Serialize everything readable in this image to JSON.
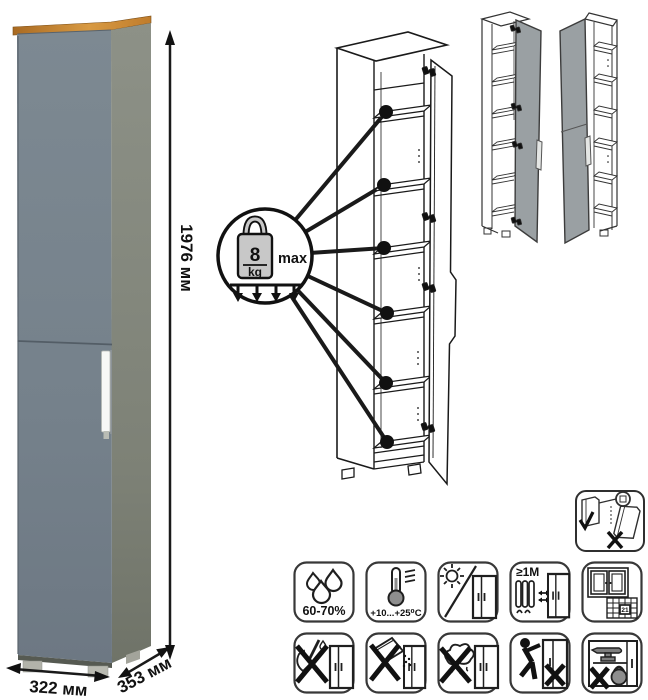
{
  "title": "tall-cabinet-dimensions-and-care-diagram",
  "product": {
    "dimensions": {
      "height_label": "1976 мм",
      "width_label": "322 мм",
      "depth_label": "353 мм"
    },
    "colors": {
      "door": "#76828c",
      "side": "#878b80",
      "wood_top": "#c9882f",
      "handle": "#f6f7f5",
      "variant_door": "#9aa0a3"
    }
  },
  "shelf_callout": {
    "weight_value": "8",
    "weight_unit": "kg",
    "max_label": "max",
    "shelf_count": 6
  },
  "care_instructions": {
    "humidity": {
      "name": "humidity-range",
      "label": "60-70%"
    },
    "temperature": {
      "name": "temperature-range",
      "label": "+10...+25⁰C"
    },
    "sunlight": {
      "name": "avoid-direct-sunlight",
      "label": ""
    },
    "heat_distance": {
      "name": "keep-distance-from-heaters",
      "label": "≥1М"
    },
    "ventilation": {
      "name": "ventilate-room-calendar",
      "label": "21"
    },
    "no_sharp": {
      "name": "no-sharp-tools"
    },
    "no_abrasive": {
      "name": "no-abrasive-powders"
    },
    "no_wet": {
      "name": "no-wet-cleaning"
    },
    "no_drag": {
      "name": "no-dragging-furniture"
    },
    "no_overload": {
      "name": "no-overloading"
    },
    "anti_tip": {
      "name": "secure-to-wall"
    }
  }
}
